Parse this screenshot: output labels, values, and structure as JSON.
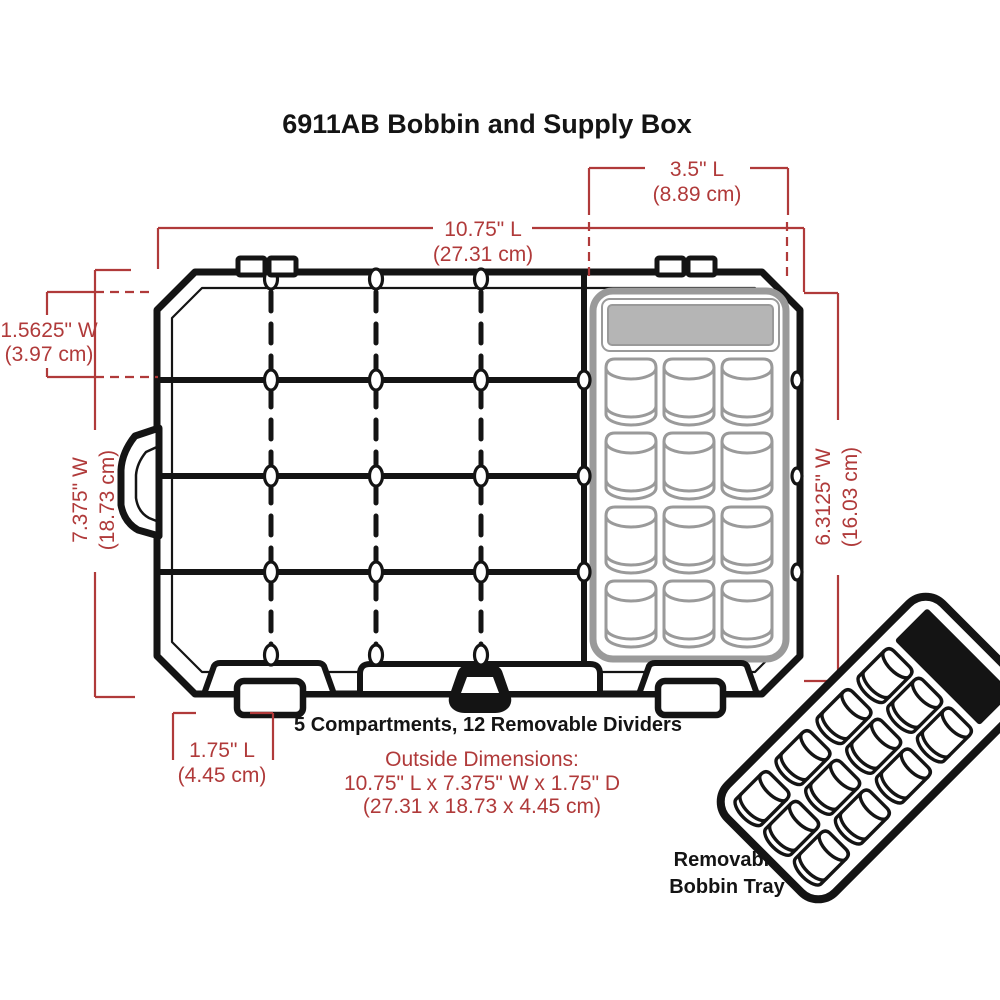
{
  "title": "6911AB Bobbin and Supply Box",
  "colors": {
    "dimension_red": "#b03a3a",
    "line_black": "#141414",
    "tray_gray": "#9a9a9a",
    "tray_plate_gray": "#b5b5b5"
  },
  "dimensions": {
    "tray_length": {
      "line1": "3.5\" L",
      "line2": "(8.89 cm)"
    },
    "box_length": {
      "line1": "10.75\" L",
      "line2": "(27.31 cm)"
    },
    "lid_width": {
      "line1": "1.5625\" W",
      "line2": "(3.97 cm)"
    },
    "box_width": {
      "line1": "7.375\" W",
      "line2": "(18.73 cm)"
    },
    "tray_width": {
      "line1": "6.3125\" W",
      "line2": "(16.03 cm)"
    },
    "latch_length": {
      "line1": "1.75\" L",
      "line2": "(4.45 cm)"
    }
  },
  "captions": {
    "compartments": "5 Compartments, 12 Removable Dividers",
    "outside_heading": "Outside Dimensions:",
    "outside_imperial": "10.75\" L x 7.375\" W x 1.75\" D",
    "outside_metric": "(27.31 x 18.73 x 4.45 cm)",
    "tray_label_line1": "Removable",
    "tray_label_line2": "Bobbin Tray"
  }
}
